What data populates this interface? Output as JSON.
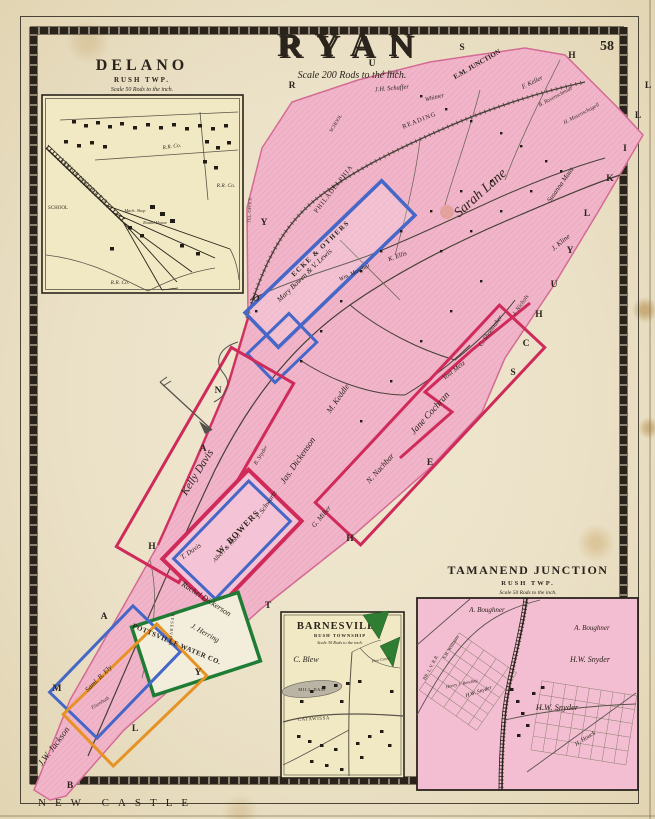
{
  "page": {
    "number": "58",
    "bottom_left_label": "NEW CASTLE"
  },
  "title": {
    "text": "RYAN",
    "scale": "Scale 200 Rods to the inch."
  },
  "colors": {
    "paper": "#ebe1c7",
    "map_pink": "#f2b4c9",
    "inset_cream": "#f1e9c3",
    "parcel_blue": "#4467c8",
    "parcel_red": "#cf2a5a",
    "parcel_green": "#1e7c35",
    "parcel_orange": "#e79224",
    "woods_green": "#2f7d33",
    "ink": "#2b241c"
  },
  "main_map": {
    "edge_letters": {
      "north": [
        "R",
        "U",
        "S",
        "H"
      ],
      "east": [
        "S",
        "C",
        "H",
        "U",
        "Y",
        "L",
        "K",
        "I",
        "L",
        "L"
      ],
      "west": [
        "M",
        "A",
        "H",
        "A",
        "N",
        "O",
        "Y"
      ],
      "south": [
        "B",
        "L",
        "Y",
        "T",
        "H",
        "E"
      ]
    },
    "labels": {
      "em_junction": "E.M. JUNCTION",
      "a_brell": "A. Brell",
      "jh_schaffer": "J.H. Schaffer",
      "whitner": "Whitner",
      "f_keller": "F. Keller",
      "b_ravenschmidt": "B. Ravenschmidt",
      "h_mosenschagell": "H. Mosenschagell",
      "school": "SCHOOL",
      "depot": "DEPOT",
      "tel_office": "TEL. OFFICE",
      "philadelphia": "PHILADELPHIA",
      "reading": "READING",
      "sarah_lane": "Sarah Lane",
      "susanna_maus": "Susanna Maus",
      "j_kline": "J. Kline",
      "k_ellis": "K. Ellis",
      "wm_maschal": "Wm. Maschal",
      "ecke_others": "ECKE & OTHERS",
      "mary_bowen": "Mary Bowen & V. Lewis",
      "kelly_davis": "Kelly Davis",
      "b_snyder": "B. Snyder",
      "jas_dickenson": "Jas. Dickenson",
      "m_keddle": "M. Keddle",
      "jane_cochran": "Jane Cochran",
      "n_nachbar": "N. Nachbar",
      "yost_metz": "Yost Metz",
      "c_shoemaker": "C. Shoemaker",
      "j_nichols": "J. Nichols",
      "j_schwartz": "J. Schwartz",
      "g_miller": "G. Miller",
      "w_bowers": "W. BOWERS",
      "albert_morel": "Albert & Morel",
      "t_davis": "T. Davis",
      "rachel_dickerson": "Rachel Dickerson",
      "j_herring": "J. Herring",
      "pottsville_water": "POTTSVILLE WATER CO.",
      "reservoir": "RESERVOIR",
      "saml_b_ely": "Saml. B. Ely",
      "eisenhuth": "Eisenhuth",
      "jw_jackson": "J.W. Jackson"
    }
  },
  "insets": {
    "delano": {
      "title": "DELANO",
      "subtitle": "RUSH TWP.",
      "scale": "Scale 50 Rods to the inch.",
      "labels": {
        "railroad": "LEHIGH VALLEY R.R.",
        "school": "SCHOOL",
        "rr_co_1": "R.R. Co.",
        "rr_co_2": "R.R. Co.",
        "rr_co_3": "R.R. Co.",
        "mach_shop": "Mach. Shop",
        "round_house": "Round House"
      }
    },
    "barnesville": {
      "title": "BARNESVILLE",
      "subtitle": "RUSH TOWNSHIP",
      "scale": "Scale 30 Rods to the inch.",
      "labels": {
        "c_blew": "C. Blew",
        "mill_dam": "MILL DAM",
        "pine_creek": "Pine Creek",
        "catawissa": "CATAWISSA"
      }
    },
    "tamanend": {
      "title": "TAMANEND JUNCTION",
      "subtitle": "RUSH TWP.",
      "scale": "Scale 50 Rods to the inch.",
      "labels": {
        "a_boughner_1": "A. Boughner",
        "a_boughner_2": "A. Boughner",
        "hw_snyder_1": "H.W. Snyder",
        "hw_snyder_2": "H.W. Snyder",
        "hw_snyder_3": "H.W. Snyder",
        "h_houck": "H. Houck",
        "sb_williams": "S.B. Williams",
        "henry_bending": "Henry J. Bending",
        "br_lv_rr": "BR. L.V. R.R."
      }
    }
  }
}
